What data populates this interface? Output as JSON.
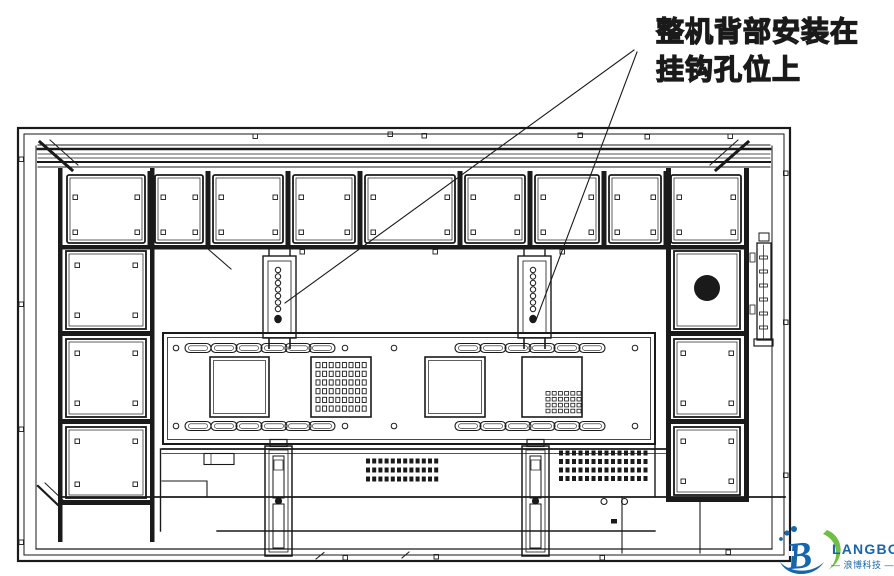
{
  "annotation": {
    "line1": "整机背部安装在",
    "line2": "挂钩孔位上"
  },
  "logo": {
    "monogram": "B",
    "brand": "LANGBO",
    "subtitle": "— 浪博科技 —",
    "blue": "#1766ad",
    "green": "#70bf44"
  },
  "colors": {
    "line": "#1a1a1a",
    "background": "#ffffff"
  }
}
